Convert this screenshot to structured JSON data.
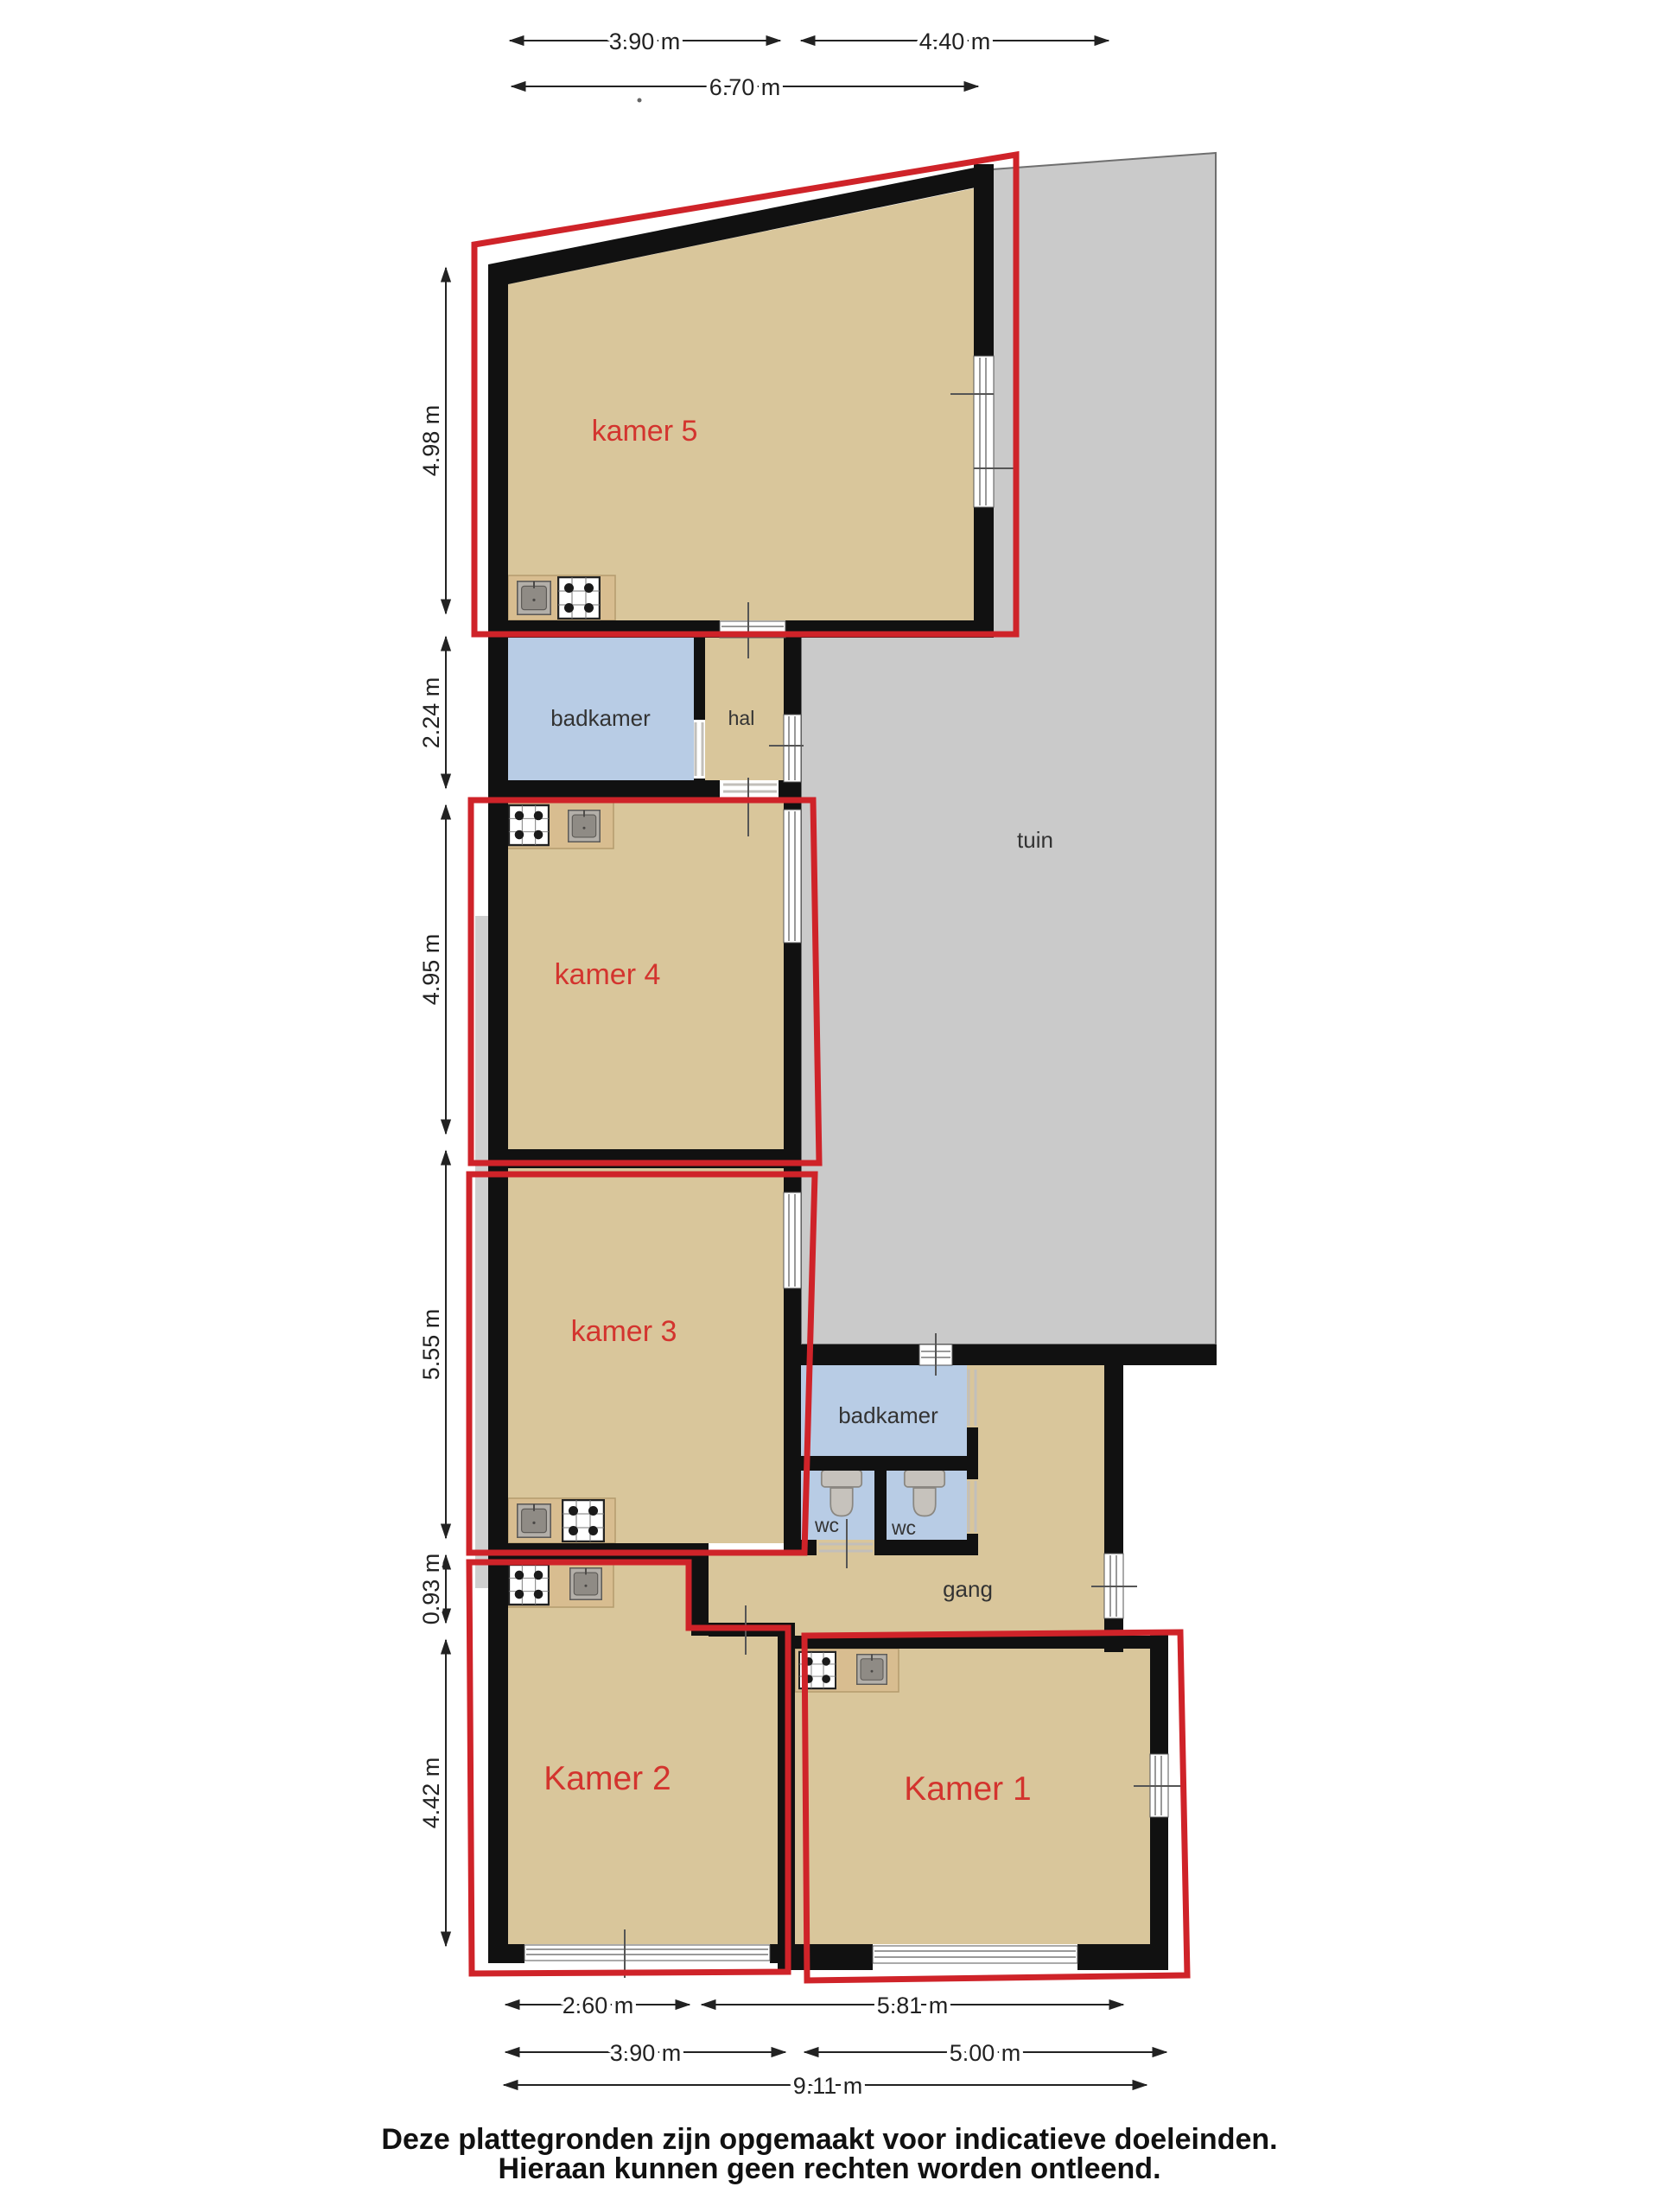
{
  "rooms": {
    "kamer5": {
      "label": "kamer 5"
    },
    "badkamer_boven": {
      "label": "badkamer"
    },
    "hal": {
      "label": "hal"
    },
    "tuin": {
      "label": "tuin"
    },
    "kamer4": {
      "label": "kamer 4"
    },
    "kamer3": {
      "label": "kamer 3"
    },
    "badkamer": {
      "label": "badkamer"
    },
    "wc_links": {
      "label": "wc"
    },
    "wc_rechts": {
      "label": "wc"
    },
    "gang": {
      "label": "gang"
    },
    "kamer2": {
      "label": "Kamer 2"
    },
    "kamer1": {
      "label": "Kamer 1"
    }
  },
  "dimensions": {
    "top": [
      {
        "label": "3.90 m"
      },
      {
        "label": "4.40 m"
      },
      {
        "label": "6.70 m"
      }
    ],
    "left": [
      {
        "label": "4.98 m"
      },
      {
        "label": "2.24 m"
      },
      {
        "label": "4.95 m"
      },
      {
        "label": "5.55 m"
      },
      {
        "label": "0.93 m"
      },
      {
        "label": "4.42 m"
      }
    ],
    "bottom": [
      {
        "label": "2.60 m"
      },
      {
        "label": "5.81 m"
      },
      {
        "label": "3.90 m"
      },
      {
        "label": "5.00 m"
      },
      {
        "label": "9.11 m"
      }
    ]
  },
  "footer": {
    "line1": "Deze plattegronden zijn opgemaakt voor indicatieve doeleinden.",
    "line2": "Hieraan kunnen geen rechten worden ontleend."
  },
  "icons": {
    "stove": "stove-icon",
    "sink": "sink-icon",
    "toilet": "toilet-icon"
  },
  "colors": {
    "floor": "#d9c69b",
    "wet_room": "#b8cce5",
    "garden": "#cacaca",
    "wall": "#111111",
    "unit_outline": "#cf2329",
    "room_label": "#d3342e",
    "counter": "#d8bd90"
  }
}
